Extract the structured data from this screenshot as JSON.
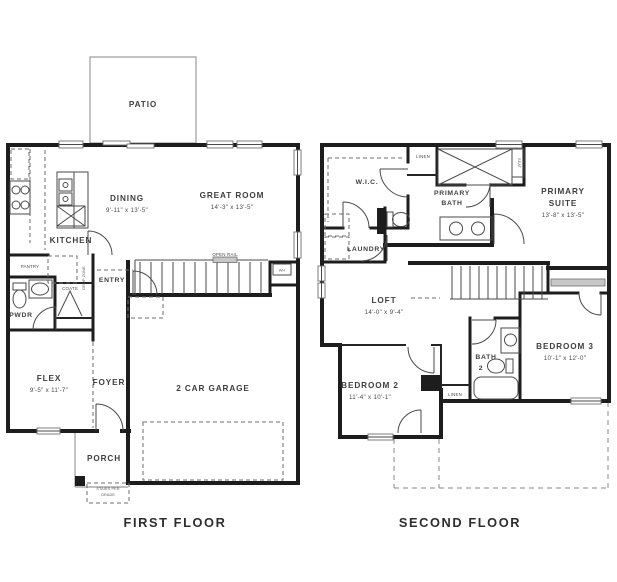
{
  "colors": {
    "wall": "#1d1d1d",
    "line": "#4a4a4a",
    "gray": "#9b9b9b",
    "text": "#3f3f3f"
  },
  "first_floor": {
    "title": "FIRST FLOOR",
    "patio": "PATIO",
    "dining": "DINING",
    "dining_dims": "9'-11\" x 13'-5\"",
    "great_room": "GREAT ROOM",
    "great_room_dims": "14'-3\" x 13'-5\"",
    "kitchen": "KITCHEN",
    "pantry": "PANTRY",
    "powder": "PWDR",
    "coats": "COATS",
    "entry": "ENTRY",
    "drop_zone": "DROP ZONE",
    "flex": "FLEX",
    "flex_dims": "9'-5\" x 11'-7\"",
    "foyer": "FOYER",
    "garage": "2 CAR GARAGE",
    "porch": "PORCH",
    "open_rail": "OPEN RAIL",
    "water_heater": "WH",
    "stairs_note_1": "STAIRS PER",
    "stairs_note_2": "GRADE"
  },
  "second_floor": {
    "title": "SECOND FLOOR",
    "wic": "W.I.C.",
    "linen_upper": "LINEN",
    "primary_bath_1": "PRIMARY",
    "primary_bath_2": "BATH",
    "seat": "SEAT",
    "primary_suite_1": "PRIMARY",
    "primary_suite_2": "SUITE",
    "primary_suite_dims": "13'-8\" x 13'-5\"",
    "laundry": "LAUNDRY",
    "loft": "LOFT",
    "loft_dims": "14'-0\" x 9'-4\"",
    "bedroom2": "BEDROOM 2",
    "bedroom2_dims": "11'-4\" x 10'-1\"",
    "bath2_1": "BATH",
    "bath2_2": "2",
    "linen_lower": "LINEN",
    "bedroom3": "BEDROOM 3",
    "bedroom3_dims": "10'-1\" x 12'-0\""
  }
}
